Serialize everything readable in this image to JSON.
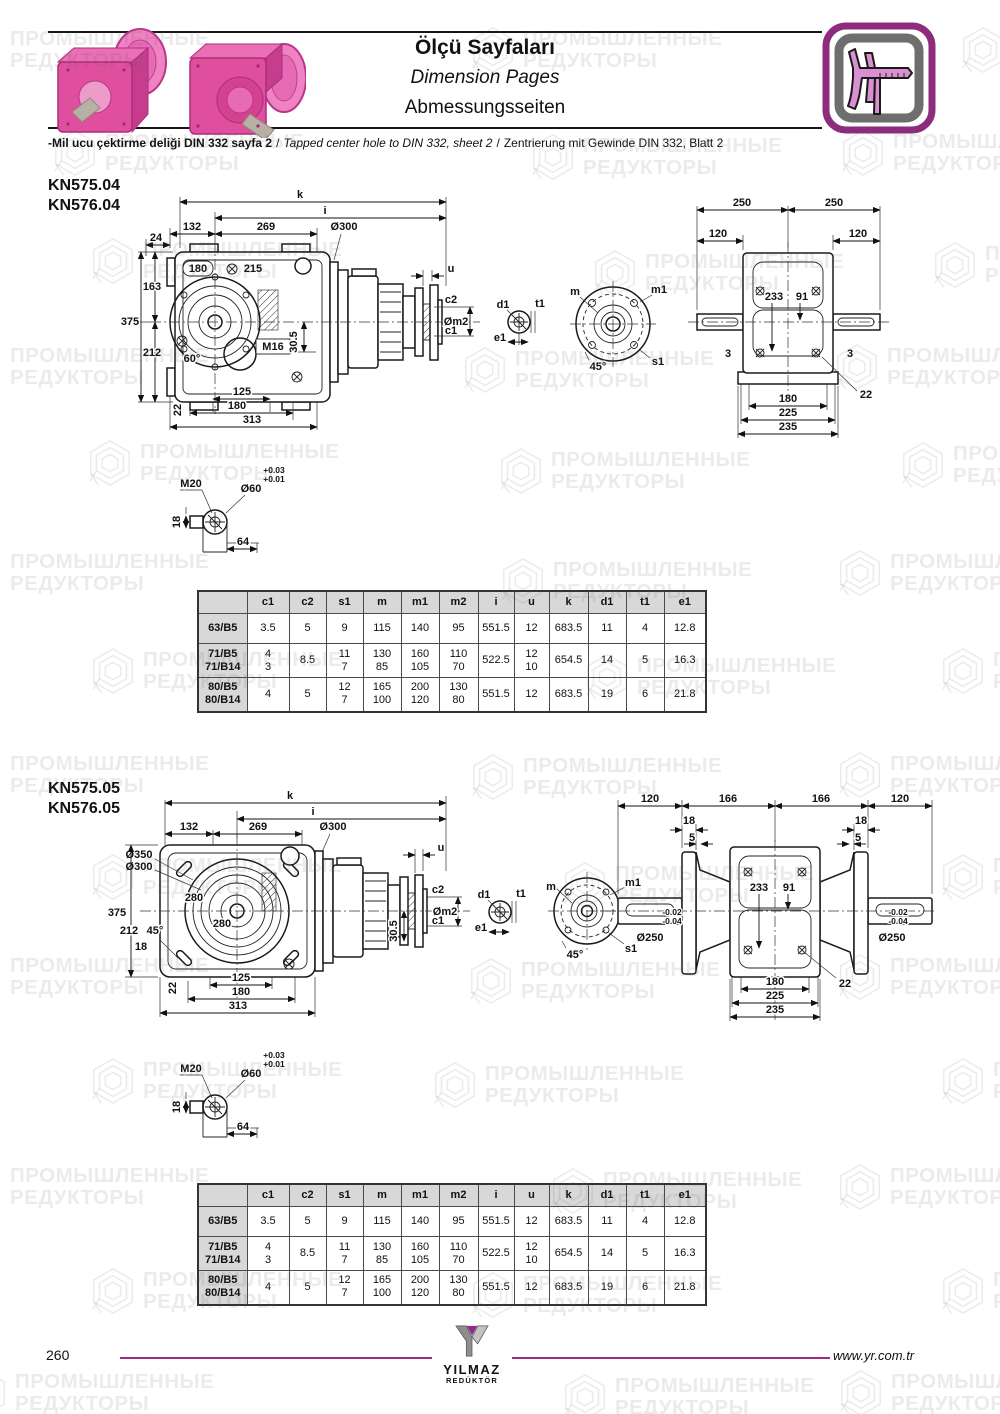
{
  "header": {
    "title_tr": "Ölçü Sayfaları",
    "title_en": "Dimension Pages",
    "title_de": "Abmessungsseiten",
    "note_tr": "-Mil ucu çektirme deliği DIN 332 sayfa 2",
    "note_sep": "/",
    "note_en": "Tapped center hole to DIN 332, sheet 2",
    "note_de": "Zentrierung mit Gewinde DIN 332, Blatt 2",
    "icon": "caliper-icon"
  },
  "watermark": {
    "line1": "ПРОМЫШЛЕННЫЕ",
    "line2": "РЕДУКТОРЫ"
  },
  "sections": [
    {
      "models": [
        "KN575.04",
        "KN576.04"
      ]
    },
    {
      "models": [
        "KN575.05",
        "KN576.05"
      ]
    }
  ],
  "dwg1": {
    "k": "k",
    "i": "i",
    "d132": "132",
    "d269": "269",
    "dia300": "Ø300",
    "d24": "24",
    "d180c": "180",
    "d215": "215",
    "d163": "163",
    "d375": "375",
    "d212": "212",
    "a60": "60°",
    "m16": "M16",
    "d305": "30.5",
    "d22": "22",
    "b125": "125",
    "b180": "180",
    "b313": "313",
    "u": "u",
    "c2": "c2",
    "m2": "Øm2",
    "c1": "c1",
    "d1": "d1",
    "t1": "t1",
    "e1": "e1",
    "m": "m",
    "m1": "m1",
    "s1": "s1",
    "a45": "45°",
    "r250a": "250",
    "r250b": "250",
    "r120a": "120",
    "r120b": "120",
    "r233": "233",
    "r91": "91",
    "r3a": "3",
    "r3b": "3",
    "r22": "22",
    "r180": "180",
    "r225": "225",
    "r235": "235"
  },
  "dwg2": {
    "k": "k",
    "i": "i",
    "d132": "132",
    "d269": "269",
    "dia300": "Ø300",
    "dia350": "Ø350",
    "dia300b": "Ø300",
    "d280a": "280",
    "d280b": "280",
    "d375": "375",
    "d212": "212",
    "a45": "45°",
    "d18": "18",
    "d305": "30.5",
    "d22": "22",
    "b125": "125",
    "b180": "180",
    "b313": "313",
    "u": "u",
    "c2": "c2",
    "m2": "Øm2",
    "c1": "c1",
    "d1": "d1",
    "t1": "t1",
    "e1": "e1",
    "m": "m",
    "m1": "m1",
    "s1": "s1",
    "fa45": "45°",
    "r120a": "120",
    "r166a": "166",
    "r166b": "166",
    "r120b": "120",
    "r18a": "18",
    "r5a": "5",
    "r18b": "18",
    "r5b": "5",
    "r233": "233",
    "r91": "91",
    "tolu_l": "-0.02",
    "toll_l": "-0.04",
    "dia250l": "Ø250",
    "tolu_r": "-0.02",
    "toll_r": "-0.04",
    "dia250r": "Ø250",
    "r22": "22",
    "r180": "180",
    "r225": "225",
    "r235": "235"
  },
  "shaft_end": {
    "m20": "M20",
    "d60": "Ø60",
    "tol_u": "+0.03",
    "tol_l": "+0.01",
    "d18": "18",
    "d64": "64"
  },
  "dim_table": {
    "headers": [
      "c1",
      "c2",
      "s1",
      "m",
      "m1",
      "m2",
      "i",
      "u",
      "k",
      "d1",
      "t1",
      "e1"
    ],
    "rows": [
      {
        "label": [
          "63/B5"
        ],
        "cells": [
          [
            "3.5"
          ],
          [
            "5"
          ],
          [
            "9"
          ],
          [
            "115"
          ],
          [
            "140"
          ],
          [
            "95"
          ],
          [
            "551.5"
          ],
          [
            "12"
          ],
          [
            "683.5"
          ],
          [
            "11"
          ],
          [
            "4"
          ],
          [
            "12.8"
          ]
        ]
      },
      {
        "label": [
          "71/B5",
          "71/B14"
        ],
        "cells": [
          [
            "4",
            "3"
          ],
          [
            "8.5"
          ],
          [
            "11",
            "7"
          ],
          [
            "130",
            "85"
          ],
          [
            "160",
            "105"
          ],
          [
            "110",
            "70"
          ],
          [
            "522.5"
          ],
          [
            "12",
            "10"
          ],
          [
            "654.5"
          ],
          [
            "14"
          ],
          [
            "5"
          ],
          [
            "16.3"
          ]
        ]
      },
      {
        "label": [
          "80/B5",
          "80/B14"
        ],
        "cells": [
          [
            "4"
          ],
          [
            "5"
          ],
          [
            "12",
            "7"
          ],
          [
            "165",
            "100"
          ],
          [
            "200",
            "120"
          ],
          [
            "130",
            "80"
          ],
          [
            "551.5"
          ],
          [
            "12"
          ],
          [
            "683.5"
          ],
          [
            "19"
          ],
          [
            "6"
          ],
          [
            "21.8"
          ]
        ]
      }
    ]
  },
  "footer": {
    "page": "260",
    "brand": "YILMAZ",
    "brand_sub": "REDÜKTÖR",
    "site": "www.yr.com.tr"
  }
}
